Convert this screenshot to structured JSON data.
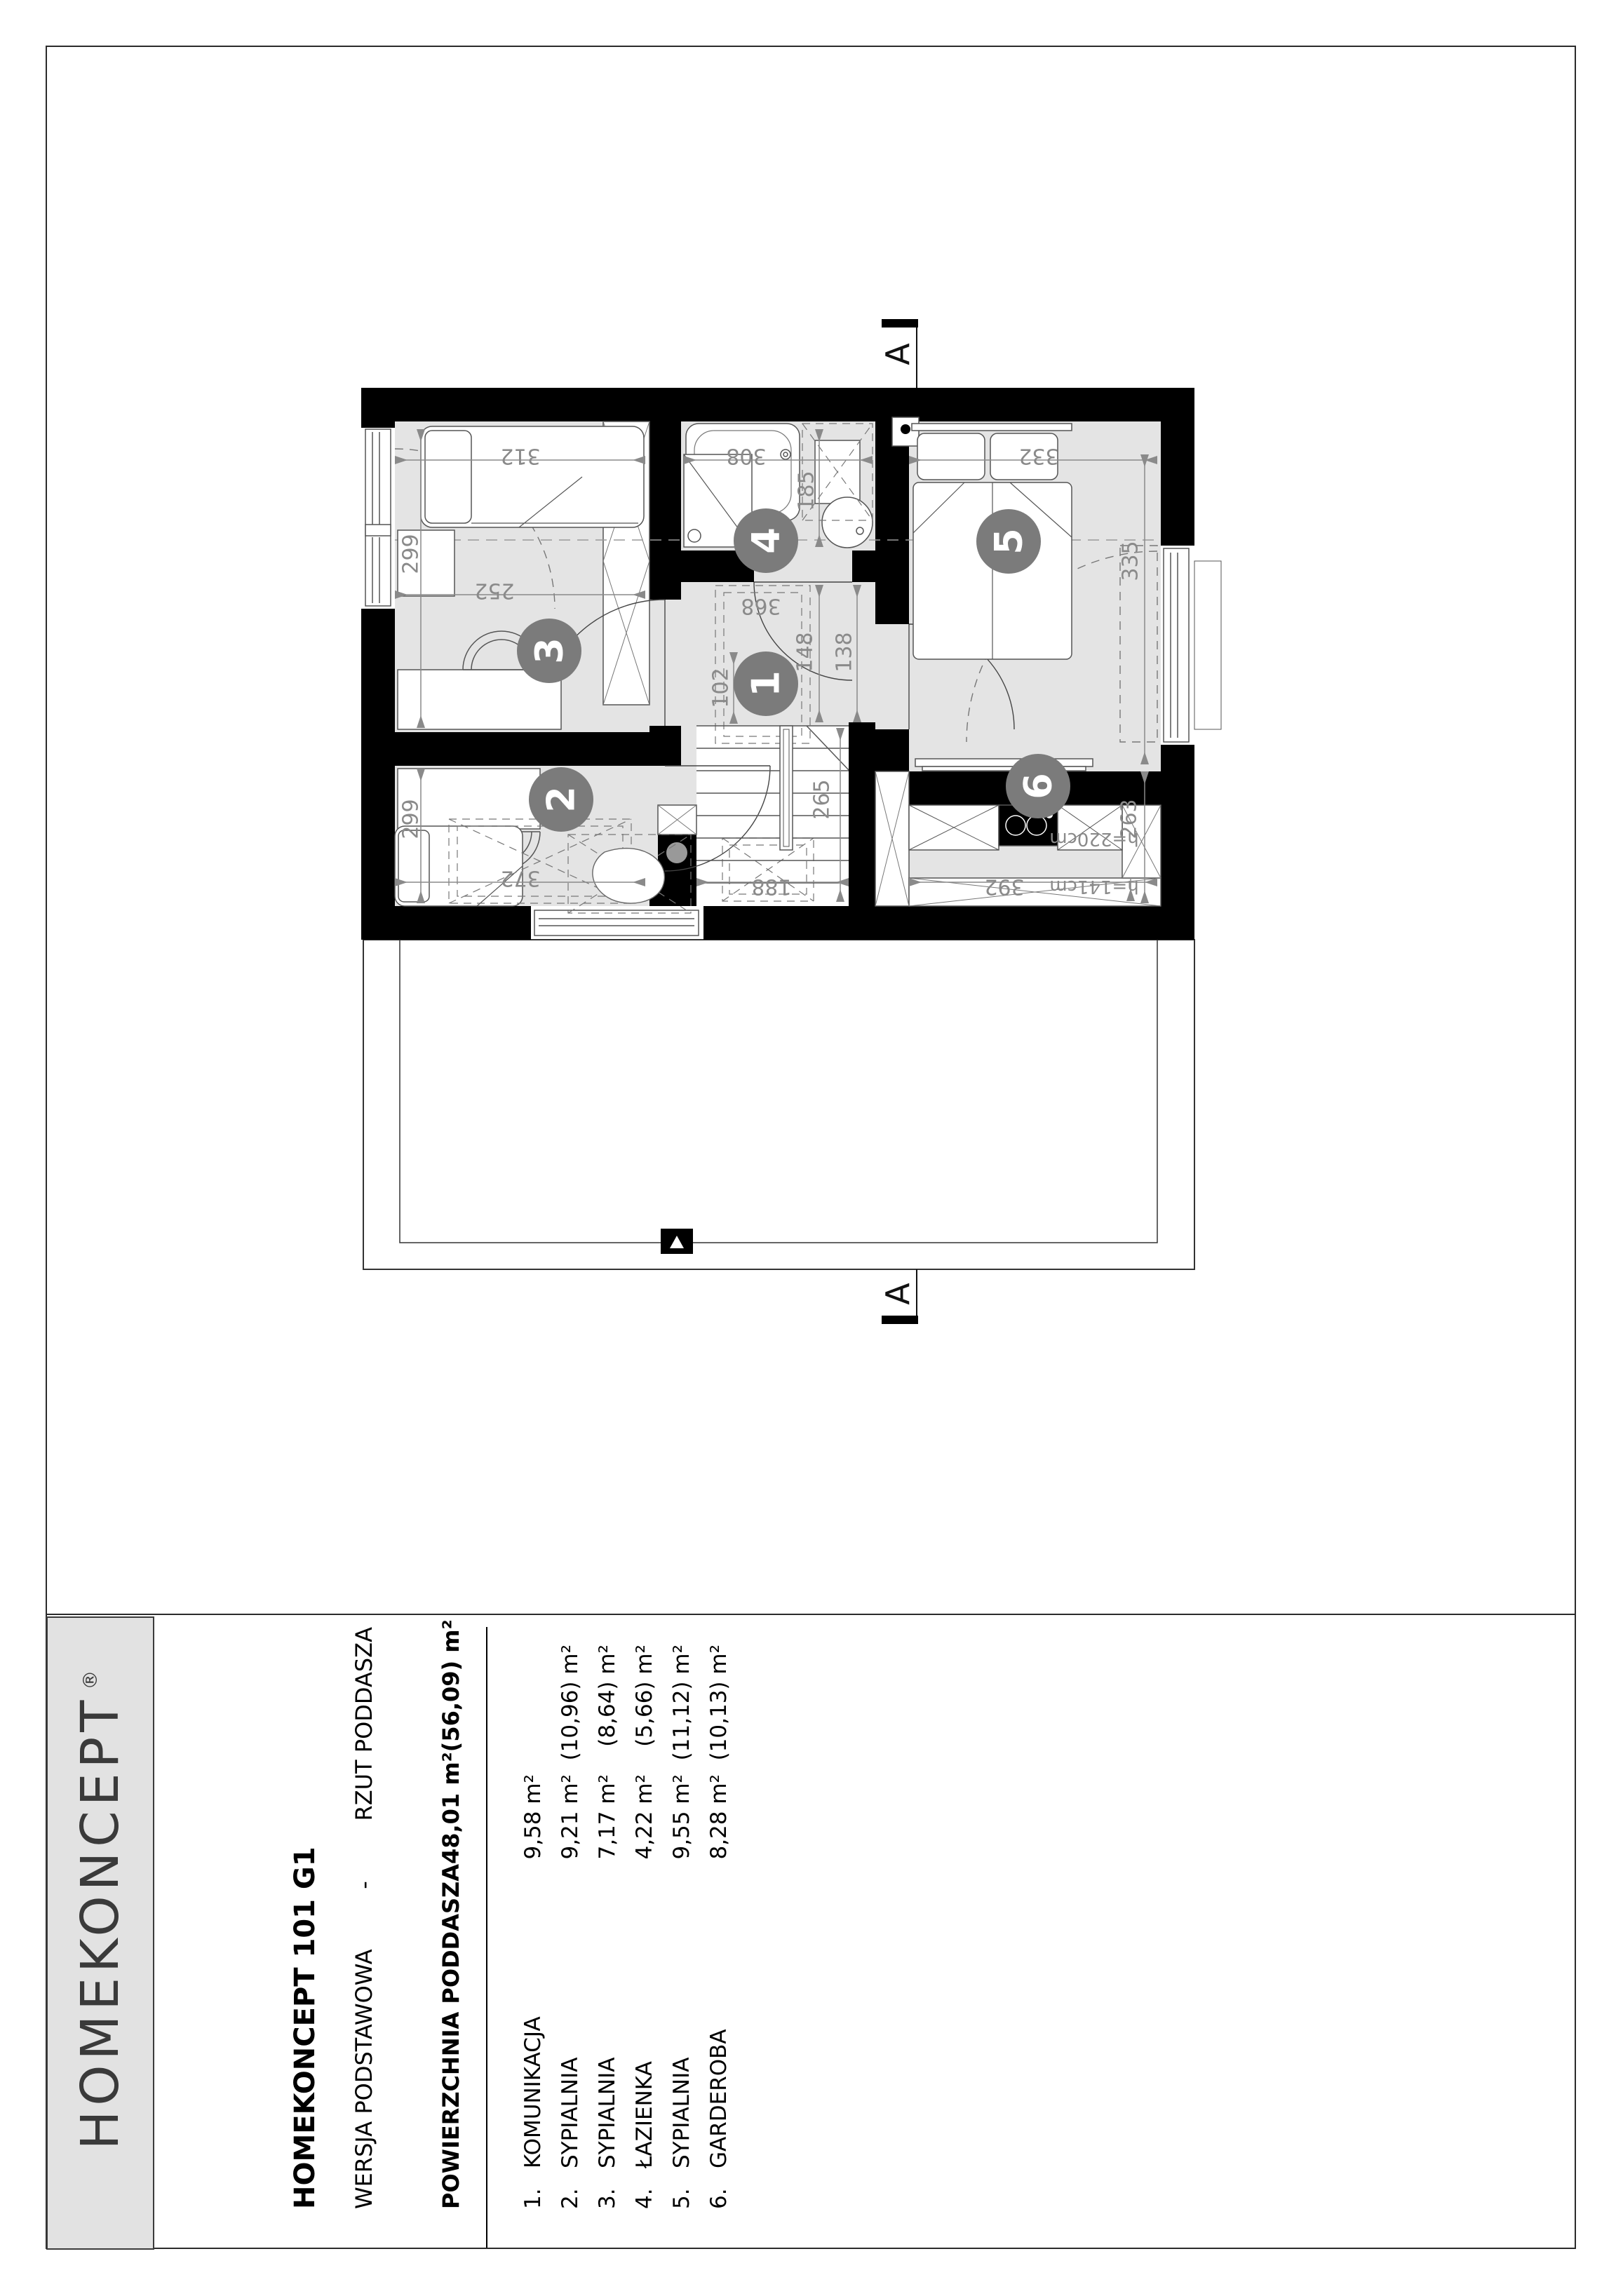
{
  "titlebar": {
    "logo": "HOMEKONCEPT",
    "logo_reg": "®",
    "project": "HOMEKONCEPT 101 G1",
    "version_label": "WERSJA  PODSTAWOWA",
    "version_sep": "-",
    "view_label": "RZUT PODDASZA",
    "area_label": "POWIERZCHNIA PODDASZA",
    "area_value": "48,01 m²",
    "area_value2": "(56,09) m²",
    "rooms": [
      {
        "no": "1.",
        "name": "KOMUNIKACJA",
        "area": "9,58 m²",
        "area2": ""
      },
      {
        "no": "2.",
        "name": "SYPIALNIA",
        "area": "9,21 m²",
        "area2": "(10,96) m²"
      },
      {
        "no": "3.",
        "name": "SYPIALNIA",
        "area": "7,17 m²",
        "area2": "(8,64) m²"
      },
      {
        "no": "4.",
        "name": "ŁAZIENKA",
        "area": "4,22 m²",
        "area2": "(5,66) m²"
      },
      {
        "no": "5.",
        "name": "SYPIALNIA",
        "area": "9,55 m²",
        "area2": "(11,12) m²"
      },
      {
        "no": "6.",
        "name": "GARDEROBA",
        "area": "8,28 m²",
        "area2": "(10,13) m²"
      }
    ]
  },
  "plan": {
    "section_label": "A",
    "room_numbers": [
      "1",
      "2",
      "3",
      "4",
      "5",
      "6"
    ],
    "dims": {
      "d312": "312",
      "d308": "308",
      "d332": "332",
      "d252": "252",
      "d299a": "299",
      "d299b": "299",
      "d185": "185",
      "d148": "148",
      "d138": "138",
      "d102": "102",
      "d368": "368",
      "d265": "265",
      "d188": "188",
      "d372": "372",
      "d392": "392",
      "d335": "335",
      "d263": "263",
      "h220": "h=220cm",
      "h141": "h=141cm"
    },
    "colors": {
      "wall": "#000000",
      "floor": "#e4e4e4",
      "dim_text": "#8a8a8a",
      "room_badge": "#7b7b7b"
    }
  }
}
